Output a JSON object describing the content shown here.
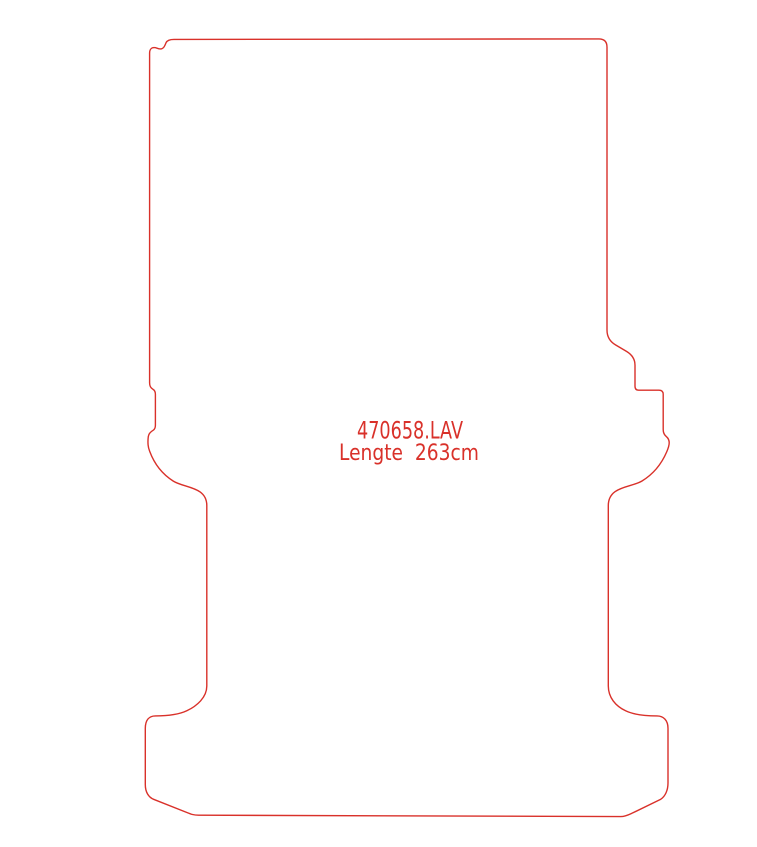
{
  "page": {
    "background_color": "#ffffff"
  },
  "drawing": {
    "type": "van-floor-mat-outline-template",
    "part_number": "470658.LAV",
    "length_label": "Lengte  263cm",
    "length_cm": 263,
    "length_unit": "cm",
    "outline_color": "#d9312a",
    "text_color": "#d9312a"
  }
}
